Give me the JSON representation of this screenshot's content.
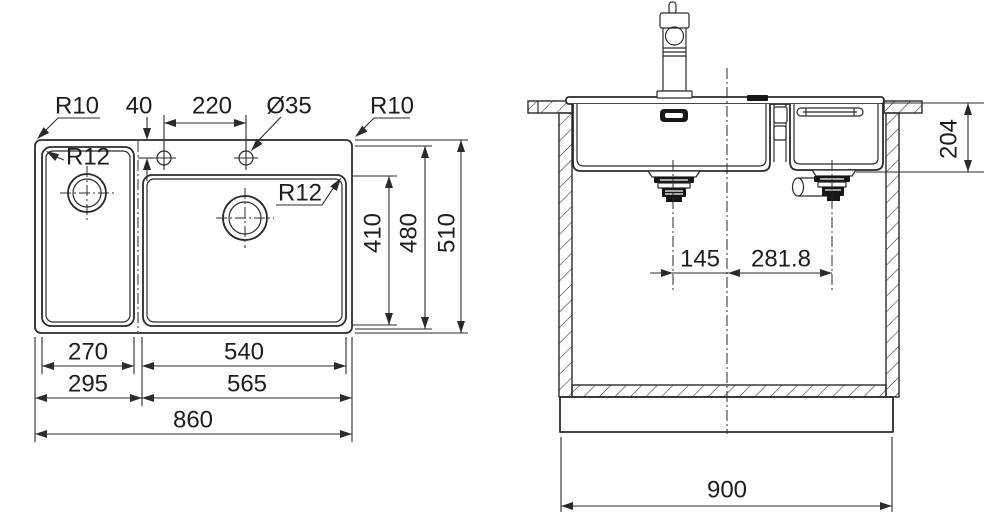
{
  "drawing": {
    "kind": "sink technical drawing, top view and section view",
    "colors": {
      "line": "#2b2b2b",
      "dark_fill": "#161616",
      "background": "#ffffff"
    }
  },
  "top_view": {
    "r10_left": "R10",
    "tap_hole_offset": "40",
    "tap_hole_spacing": "220",
    "tap_hole_diameter": "Ø35",
    "r10_right": "R10",
    "r12_left": "R12",
    "r12_main": "R12",
    "main_bowl_depth": "410",
    "bowl_depth": "480",
    "overall_depth": "510",
    "left_bowl_width": "270",
    "main_bowl_width": "540",
    "left_section_width": "295",
    "main_section_width": "565",
    "overall_width": "860"
  },
  "side_view": {
    "bowl_height": "204",
    "left_drain_offset": "145",
    "right_drain_offset": "281.8",
    "cabinet_width": "900"
  }
}
